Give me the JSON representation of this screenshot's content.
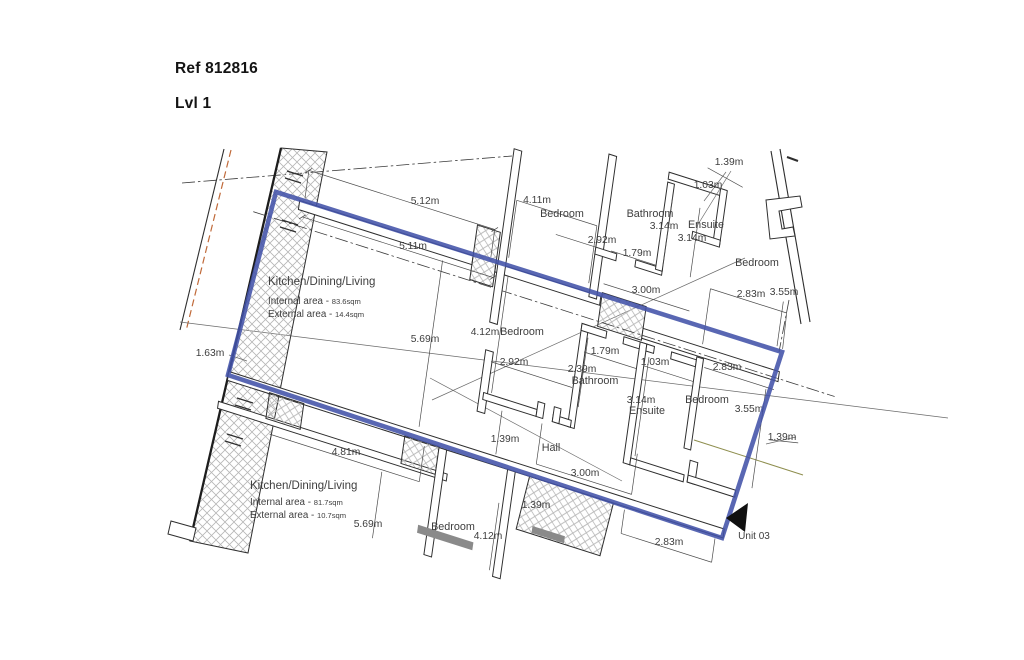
{
  "header": {
    "ref": "Ref 812816",
    "level": "Lvl 1"
  },
  "colors": {
    "boundary_blue": "#4252a8",
    "wall_line": "#2e2e2e",
    "hatch_gray": "#b6b6b6",
    "survey_orange": "#c06a3a",
    "utility_olive": "#8e8e4e",
    "text_gray": "#3e3e3e"
  },
  "plan": {
    "labels": [
      {
        "text": "5.12m",
        "x": 425,
        "y": 204,
        "cls": "dim"
      },
      {
        "text": "4.11m",
        "x": 537,
        "y": 203,
        "cls": "dim"
      },
      {
        "text": "1.39m",
        "x": 729,
        "y": 165,
        "cls": "dim"
      },
      {
        "text": "1.03m",
        "x": 708,
        "y": 188,
        "cls": "dim"
      },
      {
        "text": "3.14m",
        "x": 664,
        "y": 229,
        "cls": "dim"
      },
      {
        "text": "3.14m",
        "x": 692,
        "y": 241,
        "cls": "dim"
      },
      {
        "text": "2.92m",
        "x": 602,
        "y": 243,
        "cls": "dim"
      },
      {
        "text": "1.79m",
        "x": 637,
        "y": 256,
        "cls": "dim"
      },
      {
        "text": "5.11m",
        "x": 413,
        "y": 249,
        "cls": "dim"
      },
      {
        "text": "3.00m",
        "x": 646,
        "y": 293,
        "cls": "dim"
      },
      {
        "text": "2.83m",
        "x": 751,
        "y": 297,
        "cls": "dim"
      },
      {
        "text": "3.55m",
        "x": 784,
        "y": 295,
        "cls": "dim"
      },
      {
        "text": "4.12m",
        "x": 485,
        "y": 335,
        "cls": "dim"
      },
      {
        "text": "5.69m",
        "x": 425,
        "y": 342,
        "cls": "dim"
      },
      {
        "text": "1.63m",
        "x": 210,
        "y": 356,
        "cls": "dim"
      },
      {
        "text": "2.92m",
        "x": 514,
        "y": 365,
        "cls": "dim"
      },
      {
        "text": "1.79m",
        "x": 605,
        "y": 354,
        "cls": "dim"
      },
      {
        "text": "1.03m",
        "x": 655,
        "y": 365,
        "cls": "dim"
      },
      {
        "text": "2.83m",
        "x": 727,
        "y": 370,
        "cls": "dim"
      },
      {
        "text": "2.39m",
        "x": 582,
        "y": 372,
        "cls": "dim"
      },
      {
        "text": "3.14m",
        "x": 641,
        "y": 403,
        "cls": "dim"
      },
      {
        "text": "3.55m",
        "x": 749,
        "y": 412,
        "cls": "dim"
      },
      {
        "text": "1.39m",
        "x": 782,
        "y": 440,
        "cls": "dim"
      },
      {
        "text": "1.39m",
        "x": 505,
        "y": 442,
        "cls": "dim"
      },
      {
        "text": "3.00m",
        "x": 585,
        "y": 476,
        "cls": "dim"
      },
      {
        "text": "4.81m",
        "x": 346,
        "y": 455,
        "cls": "dim"
      },
      {
        "text": "5.69m",
        "x": 368,
        "y": 527,
        "cls": "dim"
      },
      {
        "text": "4.12m",
        "x": 488,
        "y": 539,
        "cls": "dim"
      },
      {
        "text": "2.83m",
        "x": 669,
        "y": 545,
        "cls": "dim"
      },
      {
        "text": "1.39m",
        "x": 536,
        "y": 508,
        "cls": "dim"
      },
      {
        "text": "Bedroom",
        "x": 562,
        "y": 217,
        "cls": "room"
      },
      {
        "text": "Bathroom",
        "x": 650,
        "y": 217,
        "cls": "room"
      },
      {
        "text": "Ensuite",
        "x": 706,
        "y": 228,
        "cls": "room"
      },
      {
        "text": "Bedroom",
        "x": 757,
        "y": 266,
        "cls": "room"
      },
      {
        "text": "Bedroom",
        "x": 522,
        "y": 335,
        "cls": "room"
      },
      {
        "text": "Bathroom",
        "x": 595,
        "y": 384,
        "cls": "room"
      },
      {
        "text": "Ensuite",
        "x": 647,
        "y": 414,
        "cls": "room"
      },
      {
        "text": "Bedroom",
        "x": 707,
        "y": 403,
        "cls": "room"
      },
      {
        "text": "Hall",
        "x": 551,
        "y": 451,
        "cls": "room"
      },
      {
        "text": "Bedroom",
        "x": 453,
        "y": 530,
        "cls": "room"
      },
      {
        "text": "Unit 03",
        "x": 754,
        "y": 539,
        "cls": "unit"
      }
    ],
    "area_blocks": [
      {
        "x": 268,
        "title_y": 285,
        "title": "Kitchen/Dining/Living",
        "lines": [
          {
            "y": 304,
            "label": "Internal area -",
            "value": "83.6sqm"
          },
          {
            "y": 317,
            "label": "External area -",
            "value": "14.4sqm"
          }
        ]
      },
      {
        "x": 250,
        "title_y": 489,
        "title": "Kitchen/Dining/Living",
        "lines": [
          {
            "y": 505,
            "label": "Internal area -",
            "value": "81.7sqm"
          },
          {
            "y": 518,
            "label": "External area -",
            "value": "10.7sqm"
          }
        ]
      }
    ]
  }
}
